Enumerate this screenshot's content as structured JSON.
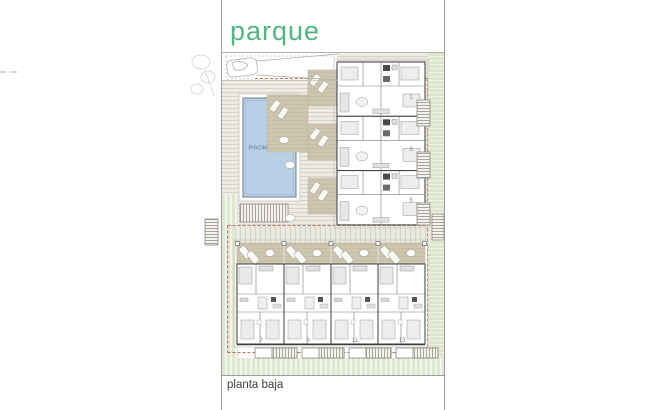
{
  "labels": {
    "park": "parque",
    "floor_name": "planta baja",
    "pool_label": "PISCINA = 84 m²"
  },
  "upper_units": [
    "1",
    "3",
    "5"
  ],
  "lower_units": [
    "7",
    "9",
    "11",
    "13"
  ],
  "colors": {
    "park_green": "#52b482",
    "pool_blue": "#b9cfe5",
    "pool_text": "#60748c",
    "boundary_red": "#b2735f",
    "terrace_tan": "#cdc5ae",
    "lawn_green": "#dde6cd",
    "number_gray": "#8a8274",
    "label_dark": "#3f3f3c"
  }
}
